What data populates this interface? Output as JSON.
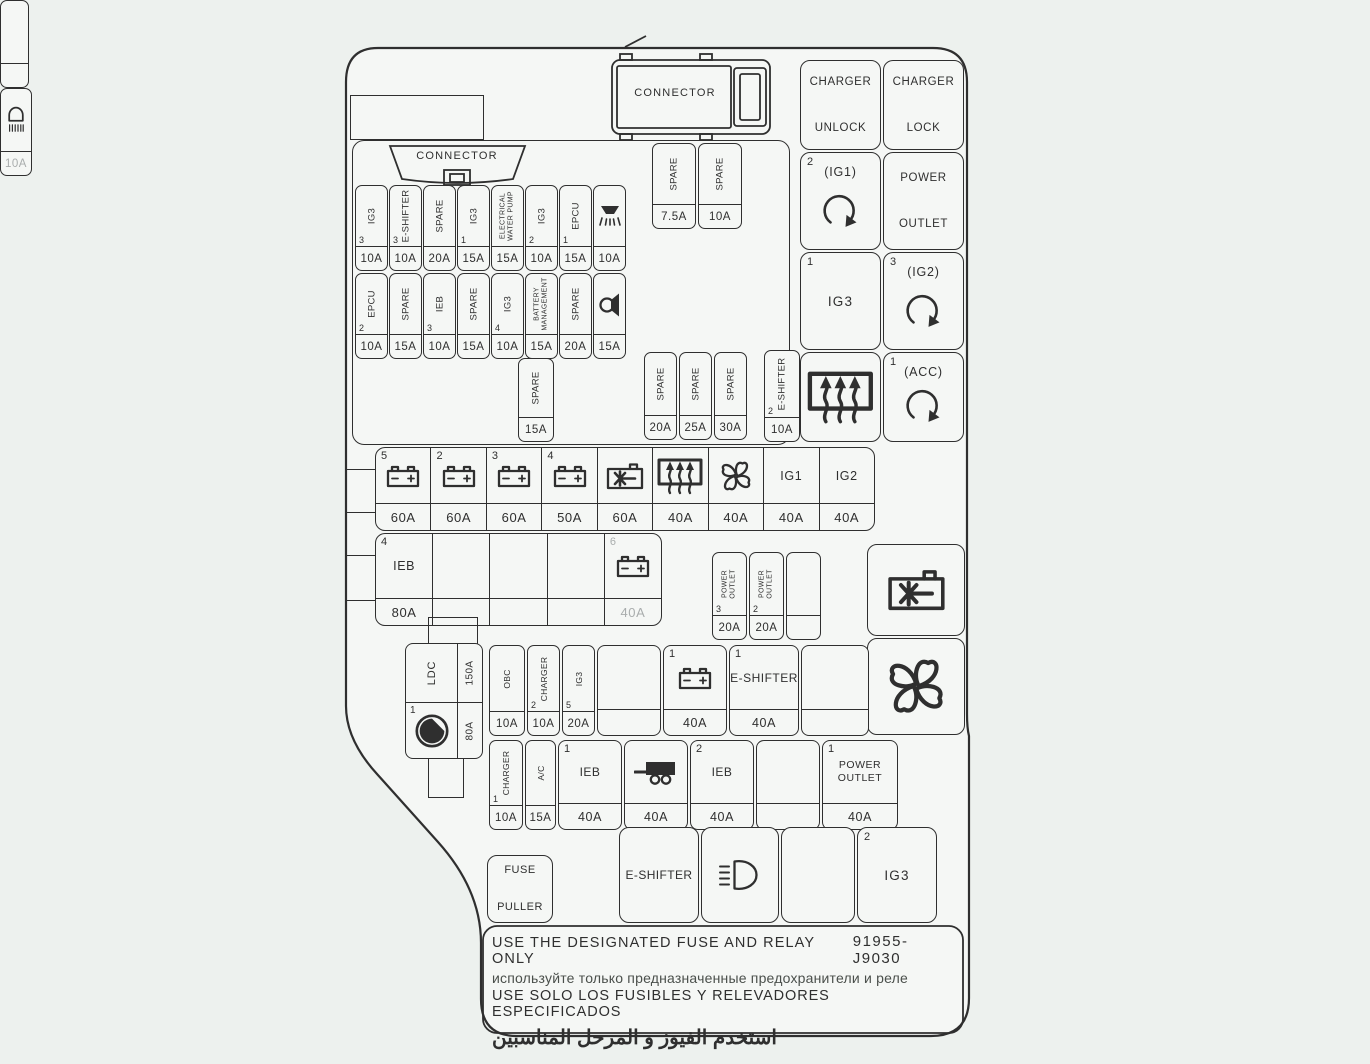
{
  "colors": {
    "bg": "#edf1ee",
    "panel": "#f5f7f5",
    "line": "#2f2f2f",
    "gray": "#a9adad"
  },
  "top": {
    "connector_label": "CONNECTOR"
  },
  "fuse_block": {
    "connector_label": "CONNECTOR",
    "top_spares": [
      {
        "label": "SPARE",
        "amp": "7.5A"
      },
      {
        "label": "SPARE",
        "amp": "10A"
      }
    ],
    "row1": [
      {
        "num": "3",
        "label": "IG3",
        "amp": "10A"
      },
      {
        "num": "3",
        "label": "E-SHIFTER",
        "amp": "10A"
      },
      {
        "label": "SPARE",
        "amp": "20A"
      },
      {
        "num": "1",
        "label": "IG3",
        "amp": "15A"
      },
      {
        "lines": [
          "ELECTRICAL",
          "WATER PUMP"
        ],
        "amp": "15A"
      },
      {
        "num": "2",
        "label": "IG3",
        "amp": "10A"
      },
      {
        "num": "1",
        "label": "EPCU",
        "amp": "15A"
      },
      {
        "icon": "downlight-icon",
        "amp": "10A"
      }
    ],
    "row2": [
      {
        "num": "2",
        "label": "EPCU",
        "amp": "10A"
      },
      {
        "label": "SPARE",
        "amp": "15A"
      },
      {
        "num": "3",
        "label": "IEB",
        "amp": "10A"
      },
      {
        "label": "SPARE",
        "amp": "15A"
      },
      {
        "num": "4",
        "label": "IG3",
        "amp": "10A"
      },
      {
        "lines": [
          "BATTERY",
          "MANAGEMENT"
        ],
        "amp": "15A"
      },
      {
        "label": "SPARE",
        "amp": "20A"
      },
      {
        "icon": "horn-icon",
        "amp": "15A"
      }
    ],
    "mid_spare": {
      "label": "SPARE",
      "amp": "15A"
    },
    "mid_spares": [
      {
        "label": "SPARE",
        "amp": "20A"
      },
      {
        "label": "SPARE",
        "amp": "25A"
      },
      {
        "label": "SPARE",
        "amp": "30A"
      }
    ]
  },
  "eshifter_fuse": {
    "num": "2",
    "label": "E-SHIFTER",
    "amp": "10A"
  },
  "right_grid": [
    {
      "lines": [
        "CHARGER",
        "UNLOCK"
      ]
    },
    {
      "lines": [
        "CHARGER",
        "LOCK"
      ]
    },
    {
      "num": "2",
      "title": "(IG1)",
      "icon": "rotary-arrow-icon"
    },
    {
      "lines": [
        "POWER",
        "OUTLET"
      ]
    },
    {
      "num": "1",
      "title": "IG3"
    },
    {
      "num": "3",
      "title": "(IG2)",
      "icon": "rotary-arrow-icon"
    },
    {
      "icon": "rear-defrost-icon"
    },
    {
      "num": "1",
      "title": "(ACC)",
      "icon": "rotary-arrow-icon"
    }
  ],
  "row4": [
    {
      "num": "5",
      "icon": "battery-icon",
      "amp": "60A"
    },
    {
      "num": "2",
      "icon": "battery-icon",
      "amp": "60A"
    },
    {
      "num": "3",
      "icon": "battery-icon",
      "amp": "60A"
    },
    {
      "num": "4",
      "icon": "battery-icon",
      "amp": "50A"
    },
    {
      "icon": "ac-compressor-icon",
      "amp": "60A"
    },
    {
      "icon": "rear-defrost-icon",
      "amp": "40A"
    },
    {
      "icon": "fan-icon",
      "amp": "40A"
    },
    {
      "label": "IG1",
      "amp": "40A"
    },
    {
      "label": "IG2",
      "amp": "40A"
    }
  ],
  "row5": [
    {
      "num": "4",
      "label": "IEB",
      "amp": "80A"
    },
    {},
    {},
    {},
    {
      "num": "6",
      "icon": "battery-icon",
      "amp": "40A",
      "gray": true
    }
  ],
  "power_outlet_group": [
    {
      "num": "3",
      "lines": [
        "POWER",
        "OUTLET"
      ],
      "amp": "20A"
    },
    {
      "num": "2",
      "lines": [
        "POWER",
        "OUTLET"
      ],
      "amp": "20A"
    },
    {}
  ],
  "right_relays": [
    {
      "icon": "ac-compressor-icon"
    },
    {
      "icon": "fan-icon"
    }
  ],
  "ldc": {
    "label": "LDC",
    "amp_top": "150A",
    "num": "1",
    "icon": "pump-icon",
    "amp_bottom": "80A"
  },
  "obc_row": [
    {
      "label": "OBC",
      "amp": "10A",
      "vertical": true
    },
    {
      "num": "2",
      "label": "CHARGER",
      "amp": "10A",
      "vertical": true
    },
    {
      "num": "5",
      "label": "IG3",
      "amp": "20A",
      "vertical": true
    },
    {},
    {
      "num": "1",
      "icon": "battery-icon",
      "amp": "40A"
    },
    {
      "num": "1",
      "label": "E-SHIFTER",
      "amp": "40A"
    },
    {}
  ],
  "lower_row": [
    {
      "num": "1",
      "label": "CHARGER",
      "amp": "10A",
      "vertical": true
    },
    {
      "label": "A/C",
      "amp": "15A",
      "vertical": true
    },
    {
      "num": "1",
      "label": "IEB",
      "amp": "40A"
    },
    {
      "icon": "trailer-icon",
      "amp": "40A"
    },
    {
      "num": "2",
      "label": "IEB",
      "amp": "40A"
    },
    {},
    {
      "num": "1",
      "lines": [
        "POWER",
        "OUTLET"
      ],
      "amp": "40A"
    }
  ],
  "bottom_row": {
    "fuse_puller_lines": [
      "FUSE",
      "PULLER"
    ],
    "lamp_fuse": {
      "icon": "interior-lamp-icon",
      "amp": "10A",
      "gray": true
    },
    "eshifter_label": "E-SHIFTER",
    "headlight": {
      "icon": "headlight-icon"
    },
    "ig3": {
      "num": "2",
      "label": "IG3"
    }
  },
  "footer": {
    "line1_en": "USE THE DESIGNATED FUSE AND RELAY ONLY",
    "part_number": "91955-J9030",
    "line2_ru": "используйте только предназначенные предохранители и реле",
    "line3_es": "USE SOLO LOS FUSIBLES Y RELEVADORES ESPECIFICADOS",
    "line4_ar": "استخدم الفيوز و المرحل المناسبين"
  }
}
